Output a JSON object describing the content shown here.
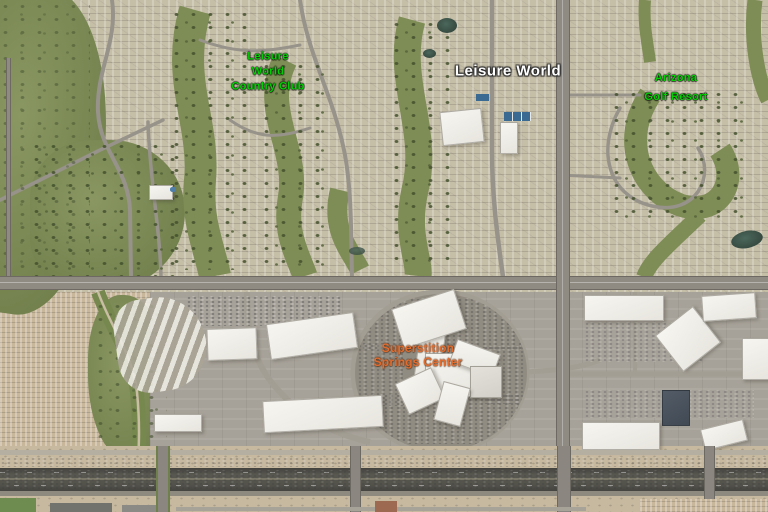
{
  "map": {
    "view": "satellite",
    "labels": {
      "country_club": {
        "line1": "Leisure",
        "line2": "World",
        "line3": "Country Club",
        "color": "#00d400",
        "category": "golf-course"
      },
      "place": {
        "text": "Leisure World",
        "color": "#ffffff",
        "category": "locality"
      },
      "golf_resort": {
        "line1": "Arizona",
        "line2": "Golf Resort",
        "color": "#00d400",
        "category": "golf-course"
      },
      "shopping_center": {
        "line1": "Superstition",
        "line2": "Springs Center",
        "color": "#e26c2e",
        "category": "shopping-mall"
      }
    },
    "terrain_colors": {
      "golf_green": "#7e8c56",
      "residential_tan": "#c6bfa8",
      "parking_gray": "#a7a298",
      "freeway_asphalt": "#53524b",
      "roof_white": "#f3f2ed",
      "dirt": "#c6b9a0"
    }
  }
}
